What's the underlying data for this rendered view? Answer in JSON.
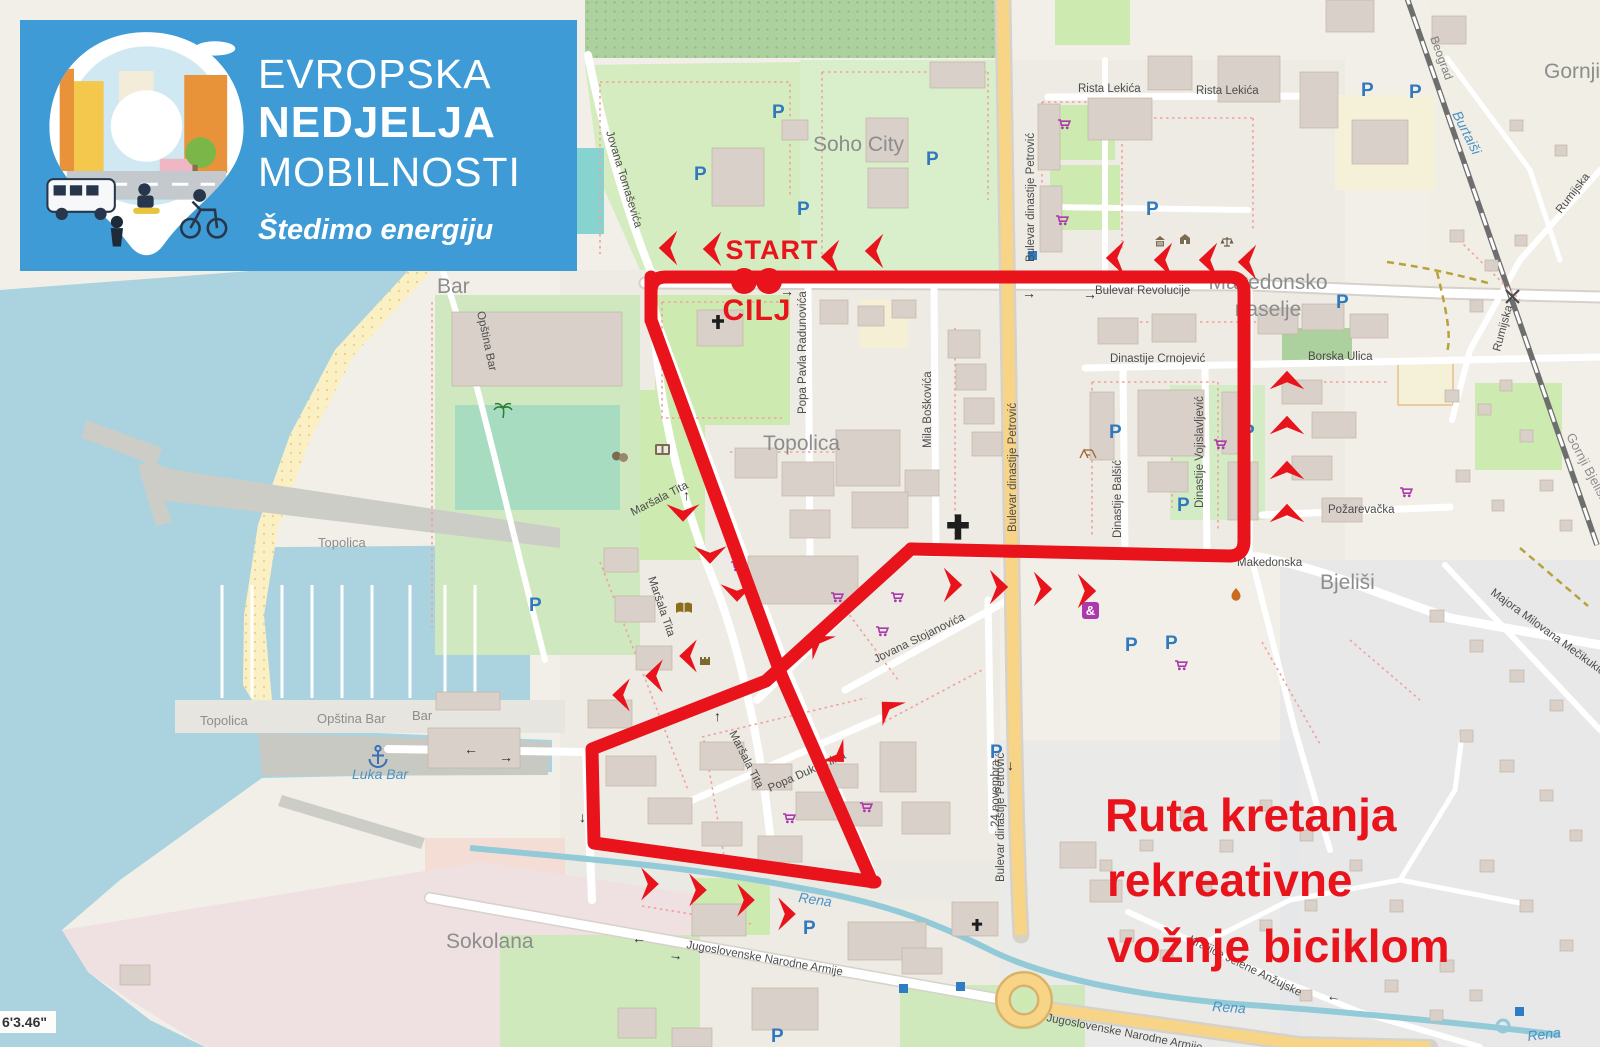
{
  "banner": {
    "line1": "EVROPSKA",
    "line2": "NEDJELJA",
    "line3": "MOBILNOSTI",
    "tagline": "Štedimo energiju"
  },
  "route_overlay": {
    "start_label": "START",
    "finish_label": "CILJ",
    "caption": [
      "Ruta kretanja",
      "rekreativne",
      "vožnje biciklom"
    ],
    "color": "#e8131b"
  },
  "corner_coordinates": "6'3.46\"",
  "map": {
    "icons": {
      "parking": "P",
      "amenity": "&"
    },
    "street_labels": [
      "Jovana Tomaševića",
      "Rista Lekića",
      "Rista Lekića",
      "Bulevar dinastije Petrović",
      "Bulevar dinastije Petrović",
      "Bulevar dinastije Petrović",
      "Bulevar Revolucije",
      "Dinastije Crnojević",
      "Borska Ulica",
      "Dinastije Balšić",
      "Dinastije Vojislavljević",
      "Mila Boškovića",
      "Popa Pavla Radunovića",
      "Maršala Tita",
      "Maršala Tita",
      "Maršala Tita",
      "Popa Dukljanina",
      "Jovana Stojanovića",
      "24 novembra",
      "Makedonska",
      "Požarevačka",
      "Rumijska",
      "Majora Milovana Mečikukića",
      "Jugoslovenske Narodne Armije",
      "Jugoslovenske Narodne Armije",
      "Kraljice Jelene Anžujske",
      "Opština Bar",
      "Rumijska"
    ],
    "place_labels": [
      "Topolica",
      "Makedonsko",
      "naselje",
      "Bjeliši",
      "Sokolana",
      "Soho City",
      "Gornji B",
      "Gornji Bjeliši",
      "Bar",
      "Topolica",
      "Topolica",
      "Opština Bar",
      "Bar"
    ],
    "water_labels": [
      "Luka Bar",
      "Rena",
      "Rena",
      "Rena",
      "Burtaiši"
    ],
    "railway_label": "Beograd"
  }
}
